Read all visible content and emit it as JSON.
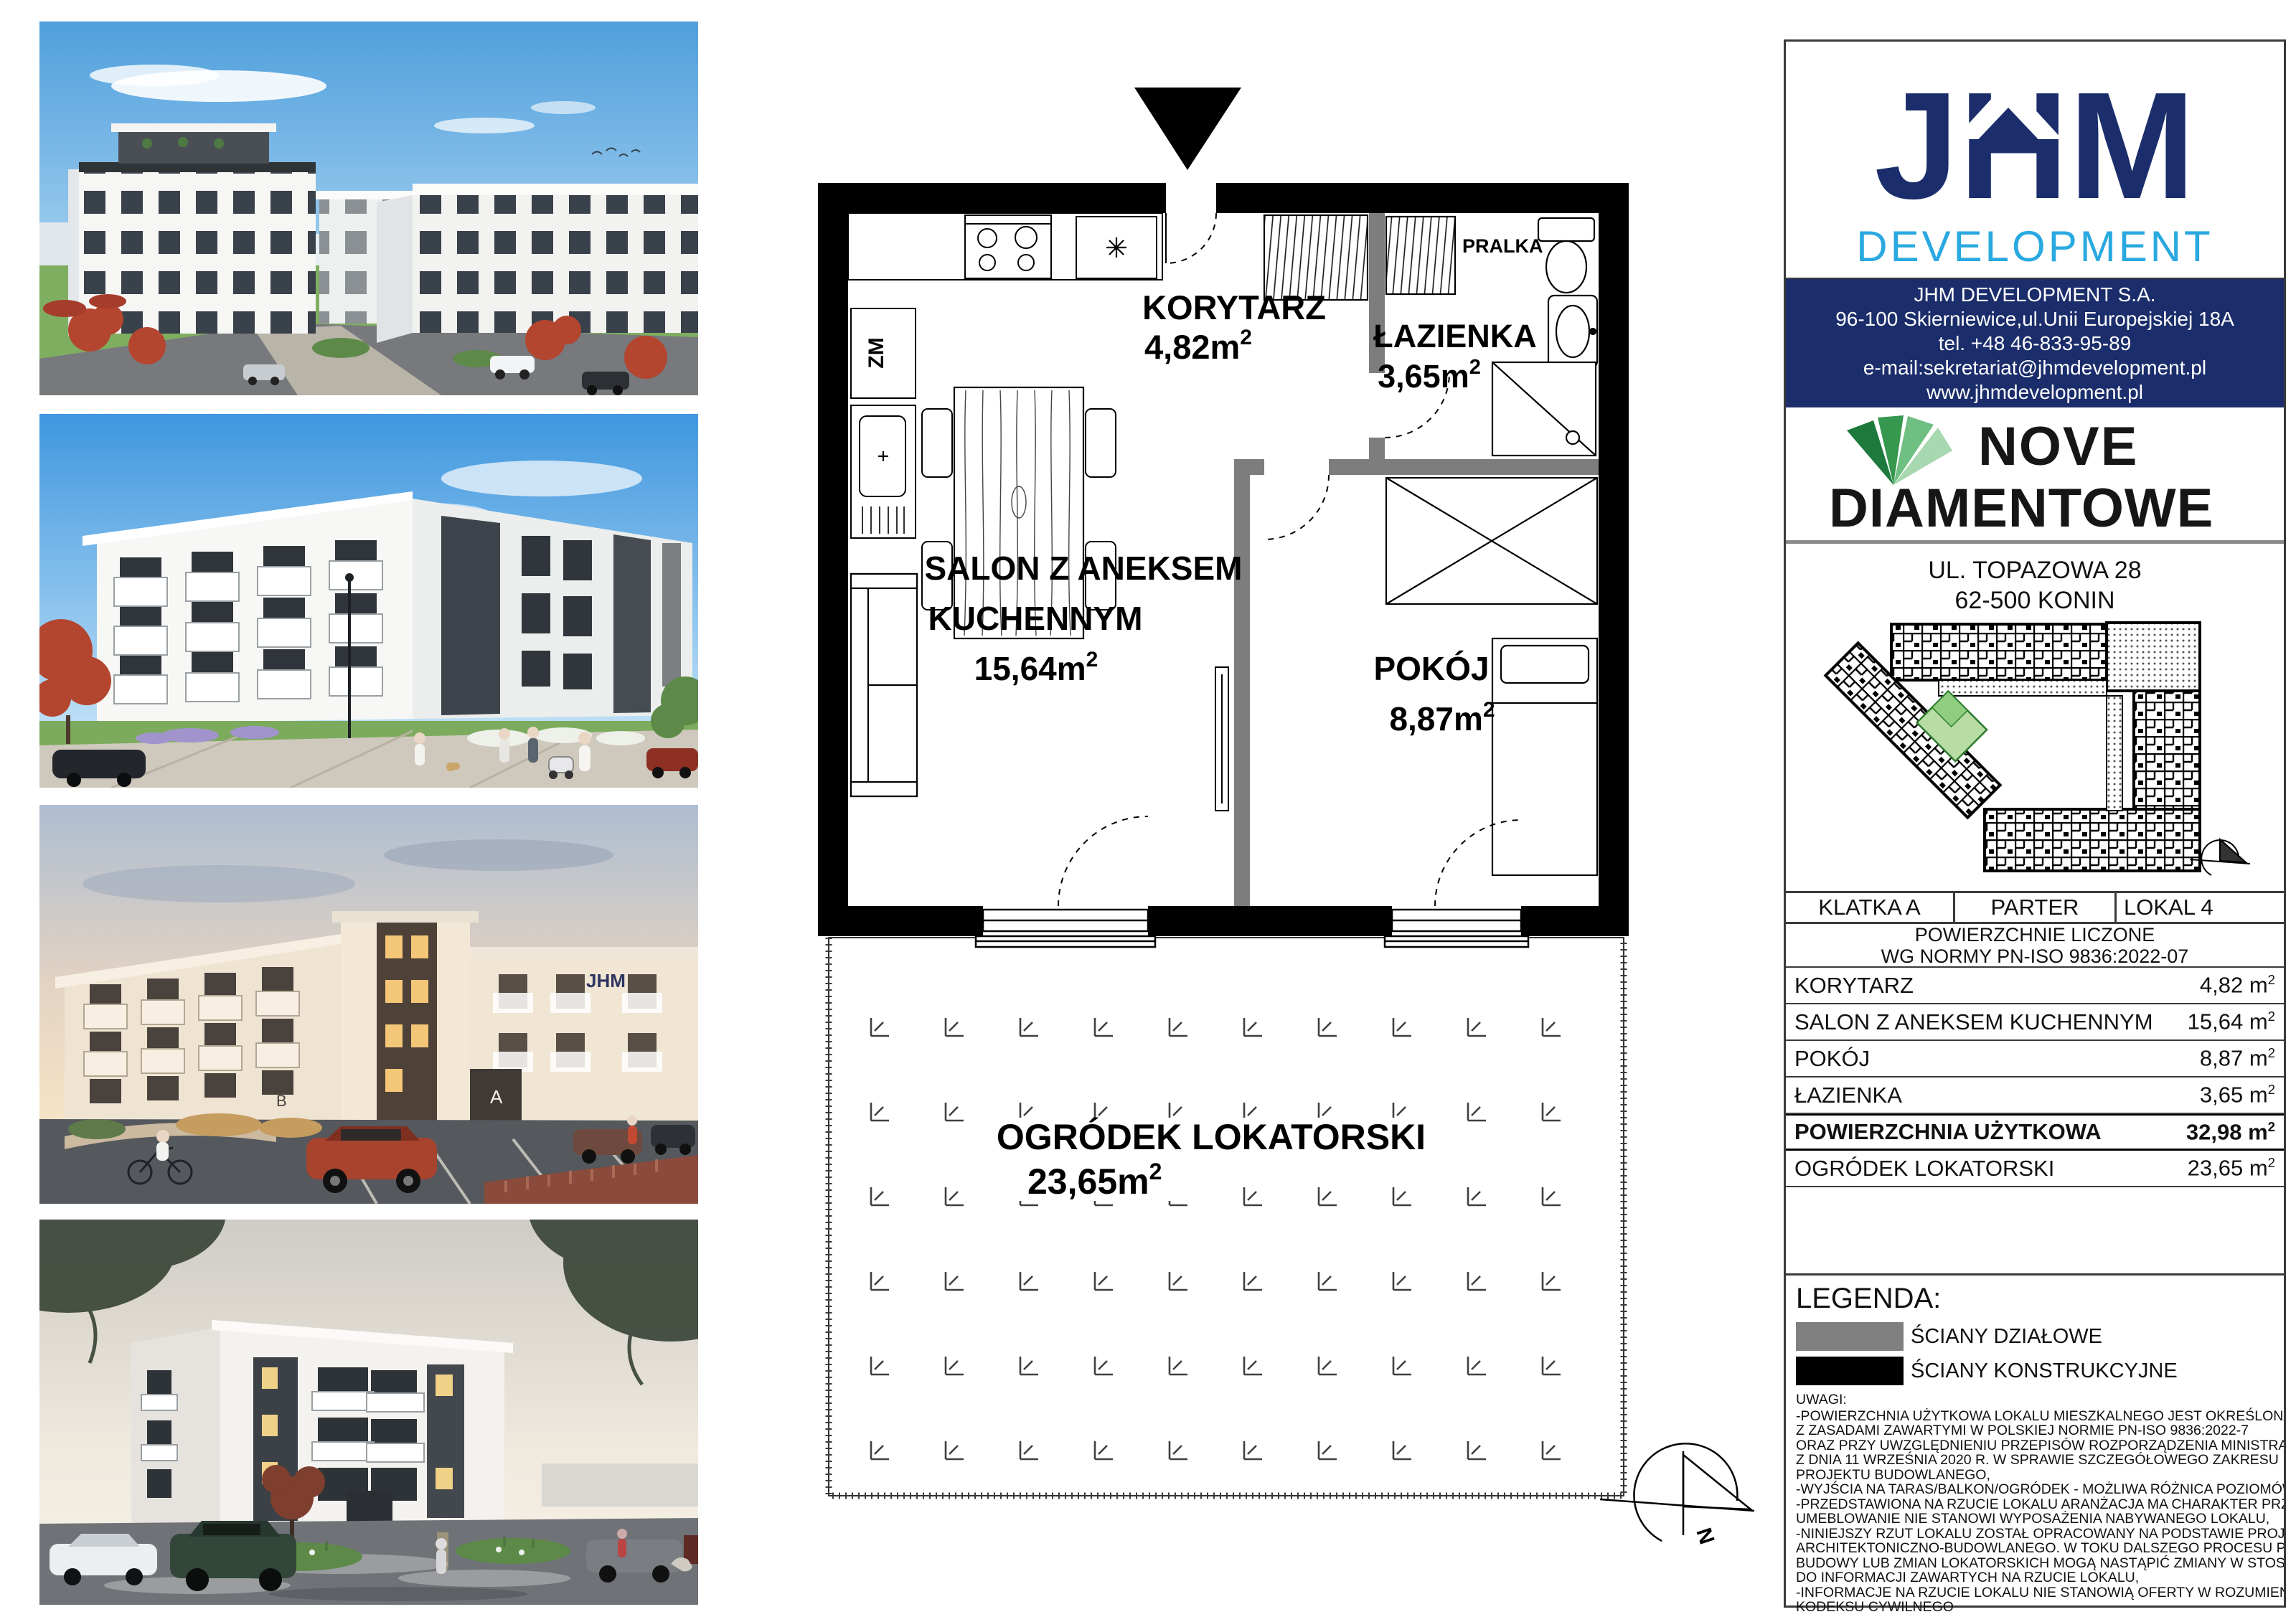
{
  "colors": {
    "navy": "#1b2d6b",
    "light_blue": "#29a9e0",
    "brand_green_dark": "#1e7a3c",
    "brand_green_light": "#a8d8b0",
    "wall_black": "#000000",
    "wall_gray": "#808080"
  },
  "units": {
    "m": "m",
    "sup": "2"
  },
  "plan": {
    "labels": {
      "korytarz": {
        "name": "KORYTARZ",
        "area": "4,82"
      },
      "lazienka": {
        "name": "ŁAZIENKA",
        "area": "3,65"
      },
      "salon": {
        "line1": "SALON Z ANEKSEM",
        "line2": "KUCHENNYM",
        "area": "15,64"
      },
      "pokoj": {
        "name": "POKÓJ",
        "area": "8,87"
      },
      "ogrodek": {
        "name": "OGRÓDEK LOKATORSKI",
        "area": "23,65"
      },
      "pralka": "PRALKA",
      "zm": "ZM"
    },
    "compass_n": "N"
  },
  "photos": {
    "sign": "JHM",
    "entrance_a": "A",
    "entrance_b": "B"
  },
  "panel": {
    "jhm": {
      "name": "JHM",
      "sub": "DEVELOPMENT"
    },
    "contact": {
      "line1": "JHM DEVELOPMENT S.A.",
      "line2": "96-100 Skierniewice,ul.Unii Europejskiej 18A",
      "line3": "tel. +48 46-833-95-89",
      "line4": "e-mail:sekretariat@jhmdevelopment.pl",
      "line5": "www.jhmdevelopment.pl"
    },
    "brand": {
      "line1": "NOVE",
      "line2": "DIAMENTOWE"
    },
    "address": {
      "line1": "UL. TOPAZOWA 28",
      "line2": "62-500 KONIN"
    },
    "unit": {
      "stair": "KLATKA A",
      "floor": "PARTER",
      "local": "LOKAL 4"
    },
    "norm": {
      "line1": "POWIERZCHNIE LICZONE",
      "line2": "WG NORMY PN-ISO 9836:2022-07"
    },
    "areas": {
      "rows": [
        {
          "label": "KORYTARZ",
          "value": "4,82"
        },
        {
          "label": "SALON Z ANEKSEM KUCHENNYM",
          "value": "15,64"
        },
        {
          "label": "POKÓJ",
          "value": "8,87"
        },
        {
          "label": "ŁAZIENKA",
          "value": "3,65"
        },
        {
          "label": "POWIERZCHNIA UŻYTKOWA",
          "value": "32,98"
        },
        {
          "label": "OGRÓDEK LOKATORSKI",
          "value": "23,65"
        }
      ]
    },
    "legend": {
      "title": "LEGENDA:",
      "items": [
        {
          "label": "ŚCIANY DZIAŁOWE",
          "color": "#808080"
        },
        {
          "label": "ŚCIANY KONSTRUKCYJNE",
          "color": "#000000"
        }
      ]
    },
    "notes": {
      "title": "UWAGI:",
      "lines": [
        "-POWIERZCHNIA UŻYTKOWA LOKALU MIESZKALNEGO JEST OKREŚLONA ZGODNIE",
        "Z ZASADAMI ZAWARTYMI W POLSKIEJ NORMIE PN-ISO 9836:2022-7",
        "ORAZ PRZY UWZGLĘDNIENIU PRZEPISÓW ROZPORZĄDZENIA MINISTRA ROZWOJU",
        "Z DNIA 11 WRZEŚNIA 2020 R. W SPRAWIE SZCZEGÓŁOWEGO ZAKRESU I FORMY",
        "PROJEKTU BUDOWLANEGO,",
        "-WYJŚCIA NA TARAS/BALKON/OGRÓDEK - MOŻLIWA RÓŻNICA POZIOMÓW,",
        "-PRZEDSTAWIONA NA RZUCIE LOKALU ARANŻACJA MA CHARAKTER PRZYKŁADOWY,",
        "UMEBLOWANIE NIE STANOWI WYPOSAŻENIA NABYWANEGO LOKALU,",
        "-NINIEJSZY RZUT LOKALU ZOSTAŁ OPRACOWANY NA PODSTAWIE PROJEKTU",
        "ARCHITEKTONICZNO-BUDOWLANEGO. W TOKU DALSZEGO PROCESU PROJEKTOWANIA,",
        "BUDOWY LUB ZMIAN LOKATORSKICH MOGĄ NASTĄPIĆ ZMIANY W STOSUNKU",
        "DO INFORMACJI ZAWARTYCH NA RZUCIE LOKALU,",
        "-INFORMACJE NA RZUCIE LOKALU NIE STANOWIĄ OFERTY W ROZUMIENIU ART. 66",
        "KODEKSU CYWILNEGO"
      ]
    }
  }
}
